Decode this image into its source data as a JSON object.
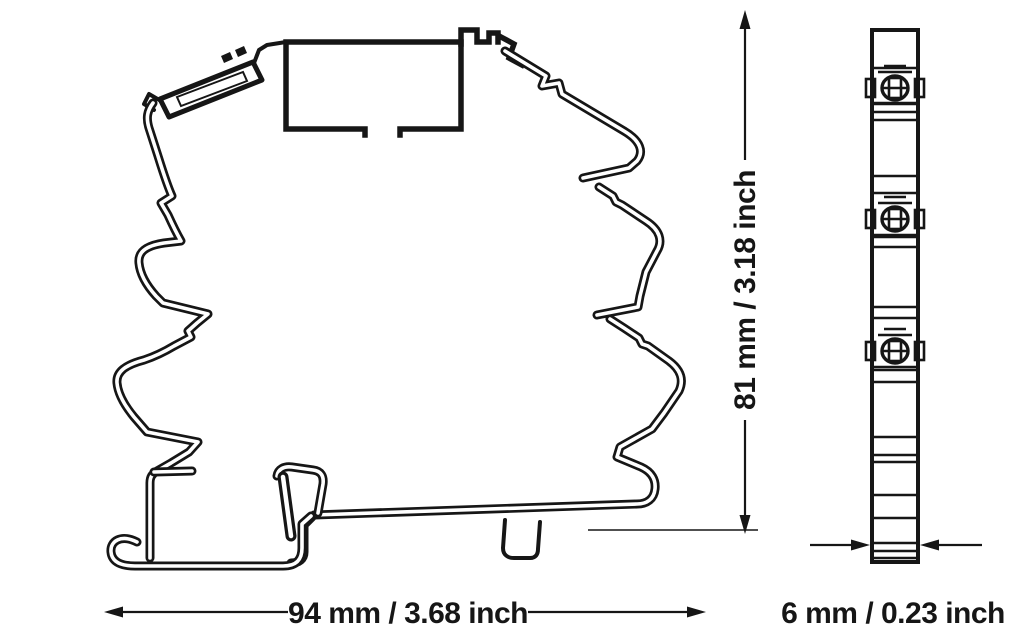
{
  "drawing": {
    "title": "relay-module-dimension-drawing",
    "views": {
      "side_view": "module side profile on DIN rail",
      "front_view": "module front edge with screw terminals"
    },
    "dimensions": {
      "width_label": "94 mm / 3.68 inch",
      "height_label": "81 mm / 3.18 inch",
      "depth_label": "6 mm / 0.23 inch"
    }
  },
  "colors": {
    "line": "#161616",
    "background": "#ffffff"
  }
}
